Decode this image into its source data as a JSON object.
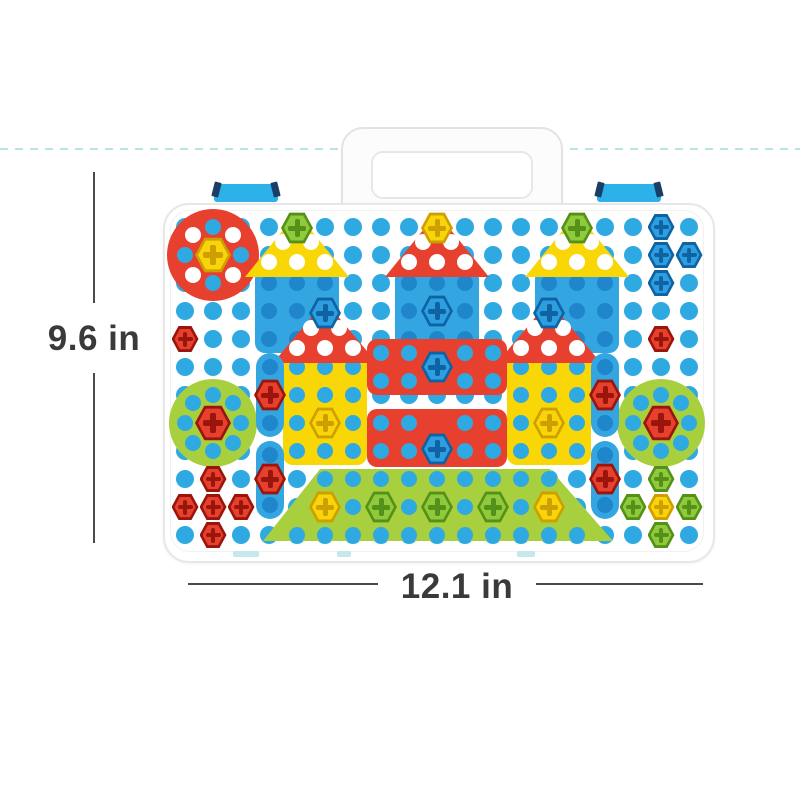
{
  "annotations": {
    "height_label": "9.6 in",
    "width_label": "12.1 in",
    "text_color": "#3a3a3a",
    "line_color": "#4a4a4a",
    "dashed_guide_color": "#b9e4e6"
  },
  "case": {
    "body_color": "#ffffff",
    "edge_color": "#e7e7e7",
    "latch_color": "#2cb1e8",
    "hinge_color": "#c3e9ec"
  },
  "board": {
    "grid": {
      "x0": 185,
      "y0": 227,
      "dx": 28,
      "dy": 28,
      "cols": 19,
      "rows": 12,
      "dot_d": 18,
      "dot_color": "#2fa9e2"
    },
    "hole_colors": {
      "blue": "#2fa9e2",
      "dblue": "#1f86cc",
      "white": "#ffffff"
    },
    "screw_colors": {
      "yellow": [
        "#f8d50a",
        "#cf9e00"
      ],
      "green": [
        "#8fc93c",
        "#559118"
      ],
      "blue": [
        "#2d9fe0",
        "#0f63a2"
      ],
      "red": [
        "#e6402e",
        "#9a150b"
      ]
    },
    "pieces": [
      {
        "name": "red-circle-piece",
        "shape": "circle",
        "x": 167,
        "y": 209,
        "w": 92,
        "h": 92,
        "color": "#e7402f",
        "holes": [
          [
            213,
            227,
            "blue"
          ],
          [
            213,
            283,
            "blue"
          ],
          [
            185,
            255,
            "blue"
          ],
          [
            241,
            255,
            "blue"
          ],
          [
            193,
            235,
            "white"
          ],
          [
            233,
            235,
            "white"
          ],
          [
            193,
            275,
            "white"
          ],
          [
            233,
            275,
            "white"
          ]
        ]
      },
      {
        "name": "green-circle-left",
        "shape": "circle",
        "x": 169,
        "y": 379,
        "w": 88,
        "h": 88,
        "color": "#a8cf3e",
        "holes": [
          [
            213,
            395,
            "blue"
          ],
          [
            213,
            451,
            "blue"
          ],
          [
            185,
            423,
            "blue"
          ],
          [
            241,
            423,
            "blue"
          ],
          [
            193,
            403,
            "blue"
          ],
          [
            233,
            403,
            "blue"
          ],
          [
            193,
            443,
            "blue"
          ],
          [
            233,
            443,
            "blue"
          ]
        ]
      },
      {
        "name": "green-circle-right",
        "shape": "circle",
        "x": 617,
        "y": 379,
        "w": 88,
        "h": 88,
        "color": "#a8cf3e",
        "holes": [
          [
            661,
            395,
            "blue"
          ],
          [
            661,
            451,
            "blue"
          ],
          [
            633,
            423,
            "blue"
          ],
          [
            689,
            423,
            "blue"
          ],
          [
            641,
            403,
            "blue"
          ],
          [
            681,
            403,
            "blue"
          ],
          [
            641,
            443,
            "blue"
          ],
          [
            681,
            443,
            "blue"
          ]
        ]
      },
      {
        "name": "blue-square-left",
        "shape": "square",
        "x": 255,
        "y": 269,
        "w": 84,
        "h": 84,
        "color": "#33a6e2",
        "holes": [
          [
            269,
            283,
            "dblue"
          ],
          [
            297,
            283,
            "dblue"
          ],
          [
            325,
            283,
            "dblue"
          ],
          [
            269,
            311,
            "dblue"
          ],
          [
            297,
            311,
            "dblue"
          ],
          [
            325,
            311,
            "dblue"
          ],
          [
            269,
            339,
            "dblue"
          ],
          [
            297,
            339,
            "dblue"
          ],
          [
            325,
            339,
            "dblue"
          ]
        ]
      },
      {
        "name": "blue-square-center",
        "shape": "square",
        "x": 395,
        "y": 269,
        "w": 84,
        "h": 84,
        "color": "#33a6e2",
        "holes": [
          [
            409,
            283,
            "dblue"
          ],
          [
            437,
            283,
            "dblue"
          ],
          [
            465,
            283,
            "dblue"
          ],
          [
            409,
            311,
            "dblue"
          ],
          [
            465,
            311,
            "dblue"
          ],
          [
            409,
            339,
            "dblue"
          ],
          [
            437,
            339,
            "dblue"
          ],
          [
            465,
            339,
            "dblue"
          ]
        ]
      },
      {
        "name": "blue-square-right",
        "shape": "square",
        "x": 535,
        "y": 269,
        "w": 84,
        "h": 84,
        "color": "#33a6e2",
        "holes": [
          [
            549,
            283,
            "dblue"
          ],
          [
            577,
            283,
            "dblue"
          ],
          [
            605,
            283,
            "dblue"
          ],
          [
            549,
            311,
            "dblue"
          ],
          [
            577,
            311,
            "dblue"
          ],
          [
            605,
            311,
            "dblue"
          ],
          [
            549,
            339,
            "dblue"
          ],
          [
            577,
            339,
            "dblue"
          ],
          [
            605,
            339,
            "dblue"
          ]
        ]
      },
      {
        "name": "yellow-wall-left",
        "shape": "square",
        "x": 283,
        "y": 353,
        "w": 84,
        "h": 112,
        "color": "#f9d606",
        "holes": [
          [
            297,
            367,
            "blue"
          ],
          [
            325,
            367,
            "blue"
          ],
          [
            353,
            367,
            "blue"
          ],
          [
            297,
            395,
            "blue"
          ],
          [
            325,
            395,
            "blue"
          ],
          [
            353,
            395,
            "blue"
          ],
          [
            297,
            423,
            "blue"
          ],
          [
            353,
            423,
            "blue"
          ],
          [
            297,
            451,
            "blue"
          ],
          [
            325,
            451,
            "blue"
          ],
          [
            353,
            451,
            "blue"
          ]
        ]
      },
      {
        "name": "yellow-wall-right",
        "shape": "square",
        "x": 507,
        "y": 353,
        "w": 84,
        "h": 112,
        "color": "#f9d606",
        "holes": [
          [
            521,
            367,
            "blue"
          ],
          [
            549,
            367,
            "blue"
          ],
          [
            577,
            367,
            "blue"
          ],
          [
            521,
            395,
            "blue"
          ],
          [
            549,
            395,
            "blue"
          ],
          [
            577,
            395,
            "blue"
          ],
          [
            521,
            423,
            "blue"
          ],
          [
            577,
            423,
            "blue"
          ],
          [
            521,
            451,
            "blue"
          ],
          [
            549,
            451,
            "blue"
          ],
          [
            577,
            451,
            "blue"
          ]
        ]
      },
      {
        "name": "red-block-upper",
        "shape": "square",
        "x": 367,
        "y": 339,
        "w": 140,
        "h": 56,
        "color": "#e7402f",
        "holes": [
          [
            381,
            353,
            "blue"
          ],
          [
            409,
            353,
            "blue"
          ],
          [
            465,
            353,
            "blue"
          ],
          [
            493,
            353,
            "blue"
          ],
          [
            381,
            381,
            "blue"
          ],
          [
            409,
            381,
            "blue"
          ],
          [
            465,
            381,
            "blue"
          ],
          [
            493,
            381,
            "blue"
          ]
        ]
      },
      {
        "name": "red-block-lower",
        "shape": "square",
        "x": 367,
        "y": 409,
        "w": 140,
        "h": 58,
        "color": "#e7402f",
        "holes": [
          [
            381,
            423,
            "blue"
          ],
          [
            409,
            423,
            "blue"
          ],
          [
            465,
            423,
            "blue"
          ],
          [
            493,
            423,
            "blue"
          ],
          [
            381,
            451,
            "blue"
          ],
          [
            409,
            451,
            "blue"
          ],
          [
            465,
            451,
            "blue"
          ],
          [
            493,
            451,
            "blue"
          ]
        ]
      },
      {
        "name": "yellow-roof-left",
        "shape": "triangle",
        "x": 245,
        "y": 213,
        "w": 104,
        "h": 64,
        "color": "#f9d606",
        "holes": [
          [
            269,
            262,
            "white"
          ],
          [
            297,
            262,
            "white"
          ],
          [
            325,
            262,
            "white"
          ],
          [
            283,
            242,
            "white"
          ],
          [
            311,
            242,
            "white"
          ]
        ]
      },
      {
        "name": "red-roof-center",
        "shape": "triangle",
        "x": 385,
        "y": 213,
        "w": 104,
        "h": 64,
        "color": "#e7402f",
        "holes": [
          [
            409,
            262,
            "white"
          ],
          [
            437,
            262,
            "white"
          ],
          [
            465,
            262,
            "white"
          ],
          [
            423,
            242,
            "white"
          ],
          [
            451,
            242,
            "white"
          ]
        ]
      },
      {
        "name": "yellow-roof-right",
        "shape": "triangle",
        "x": 525,
        "y": 213,
        "w": 104,
        "h": 64,
        "color": "#f9d606",
        "holes": [
          [
            549,
            262,
            "white"
          ],
          [
            577,
            262,
            "white"
          ],
          [
            605,
            262,
            "white"
          ],
          [
            563,
            242,
            "white"
          ],
          [
            591,
            242,
            "white"
          ]
        ]
      },
      {
        "name": "red-roof-left2",
        "shape": "triangle",
        "x": 273,
        "y": 301,
        "w": 104,
        "h": 62,
        "color": "#e7402f",
        "holes": [
          [
            297,
            348,
            "white"
          ],
          [
            325,
            348,
            "white"
          ],
          [
            353,
            348,
            "white"
          ],
          [
            311,
            328,
            "white"
          ],
          [
            339,
            328,
            "white"
          ]
        ]
      },
      {
        "name": "red-roof-right2",
        "shape": "triangle",
        "x": 497,
        "y": 301,
        "w": 104,
        "h": 62,
        "color": "#e7402f",
        "holes": [
          [
            521,
            348,
            "white"
          ],
          [
            549,
            348,
            "white"
          ],
          [
            577,
            348,
            "white"
          ],
          [
            535,
            328,
            "white"
          ],
          [
            563,
            328,
            "white"
          ]
        ]
      },
      {
        "name": "blue-strip-left-top",
        "shape": "pill",
        "x": 256,
        "y": 353,
        "w": 28,
        "h": 84,
        "color": "#33a6e2",
        "holes": [
          [
            270,
            367,
            "dblue"
          ],
          [
            270,
            423,
            "dblue"
          ]
        ]
      },
      {
        "name": "blue-strip-left-bottom",
        "shape": "pill",
        "x": 256,
        "y": 441,
        "w": 28,
        "h": 78,
        "color": "#33a6e2",
        "holes": [
          [
            270,
            455,
            "dblue"
          ],
          [
            270,
            505,
            "dblue"
          ]
        ]
      },
      {
        "name": "blue-strip-right-top",
        "shape": "pill",
        "x": 591,
        "y": 353,
        "w": 28,
        "h": 84,
        "color": "#33a6e2",
        "holes": [
          [
            605,
            367,
            "dblue"
          ],
          [
            605,
            423,
            "dblue"
          ]
        ]
      },
      {
        "name": "blue-strip-right-bottom",
        "shape": "pill",
        "x": 591,
        "y": 441,
        "w": 28,
        "h": 78,
        "color": "#33a6e2",
        "holes": [
          [
            605,
            455,
            "dblue"
          ],
          [
            605,
            505,
            "dblue"
          ]
        ]
      },
      {
        "name": "green-base-trapezoid",
        "shape": "trapezoid",
        "x": 263,
        "y": 469,
        "w": 350,
        "h": 72,
        "color": "#a8cf3e",
        "clip": "polygon(16.3% 0%, 82% 0%, 100% 100%, 0% 100%)",
        "holes": [
          [
            325,
            479,
            "blue"
          ],
          [
            353,
            479,
            "blue"
          ],
          [
            381,
            479,
            "blue"
          ],
          [
            409,
            479,
            "blue"
          ],
          [
            437,
            479,
            "blue"
          ],
          [
            465,
            479,
            "blue"
          ],
          [
            493,
            479,
            "blue"
          ],
          [
            521,
            479,
            "blue"
          ],
          [
            549,
            479,
            "blue"
          ],
          [
            353,
            507,
            "blue"
          ],
          [
            409,
            507,
            "blue"
          ],
          [
            465,
            507,
            "blue"
          ],
          [
            521,
            507,
            "blue"
          ],
          [
            297,
            535,
            "blue"
          ],
          [
            325,
            535,
            "blue"
          ],
          [
            353,
            535,
            "blue"
          ],
          [
            381,
            535,
            "blue"
          ],
          [
            409,
            535,
            "blue"
          ],
          [
            437,
            535,
            "blue"
          ],
          [
            465,
            535,
            "blue"
          ],
          [
            493,
            535,
            "blue"
          ],
          [
            521,
            535,
            "blue"
          ],
          [
            549,
            535,
            "blue"
          ],
          [
            577,
            535,
            "blue"
          ]
        ]
      }
    ],
    "screws": [
      [
        213,
        255,
        "yellow",
        36
      ],
      [
        297,
        228,
        "green"
      ],
      [
        437,
        228,
        "yellow"
      ],
      [
        577,
        228,
        "green"
      ],
      [
        437,
        311,
        "blue"
      ],
      [
        325,
        313,
        "blue"
      ],
      [
        549,
        313,
        "blue"
      ],
      [
        437,
        367,
        "blue"
      ],
      [
        437,
        449,
        "blue"
      ],
      [
        325,
        423,
        "yellow"
      ],
      [
        549,
        423,
        "yellow"
      ],
      [
        213,
        423,
        "red",
        36
      ],
      [
        661,
        423,
        "red",
        36
      ],
      [
        270,
        395,
        "red"
      ],
      [
        270,
        479,
        "red"
      ],
      [
        605,
        395,
        "red"
      ],
      [
        605,
        479,
        "red"
      ],
      [
        325,
        507,
        "yellow"
      ],
      [
        381,
        507,
        "green"
      ],
      [
        437,
        507,
        "green"
      ],
      [
        493,
        507,
        "green"
      ],
      [
        549,
        507,
        "yellow"
      ]
    ],
    "nuts": [
      [
        661,
        227,
        "blue"
      ],
      [
        661,
        255,
        "blue"
      ],
      [
        689,
        255,
        "blue"
      ],
      [
        661,
        283,
        "blue"
      ],
      [
        185,
        339,
        "red"
      ],
      [
        661,
        339,
        "red"
      ],
      [
        213,
        479,
        "red"
      ],
      [
        185,
        507,
        "red"
      ],
      [
        213,
        507,
        "red"
      ],
      [
        241,
        507,
        "red"
      ],
      [
        213,
        535,
        "red"
      ],
      [
        661,
        479,
        "green"
      ],
      [
        633,
        507,
        "green"
      ],
      [
        689,
        507,
        "green"
      ],
      [
        661,
        535,
        "green"
      ],
      [
        661,
        507,
        "yellow"
      ]
    ]
  }
}
